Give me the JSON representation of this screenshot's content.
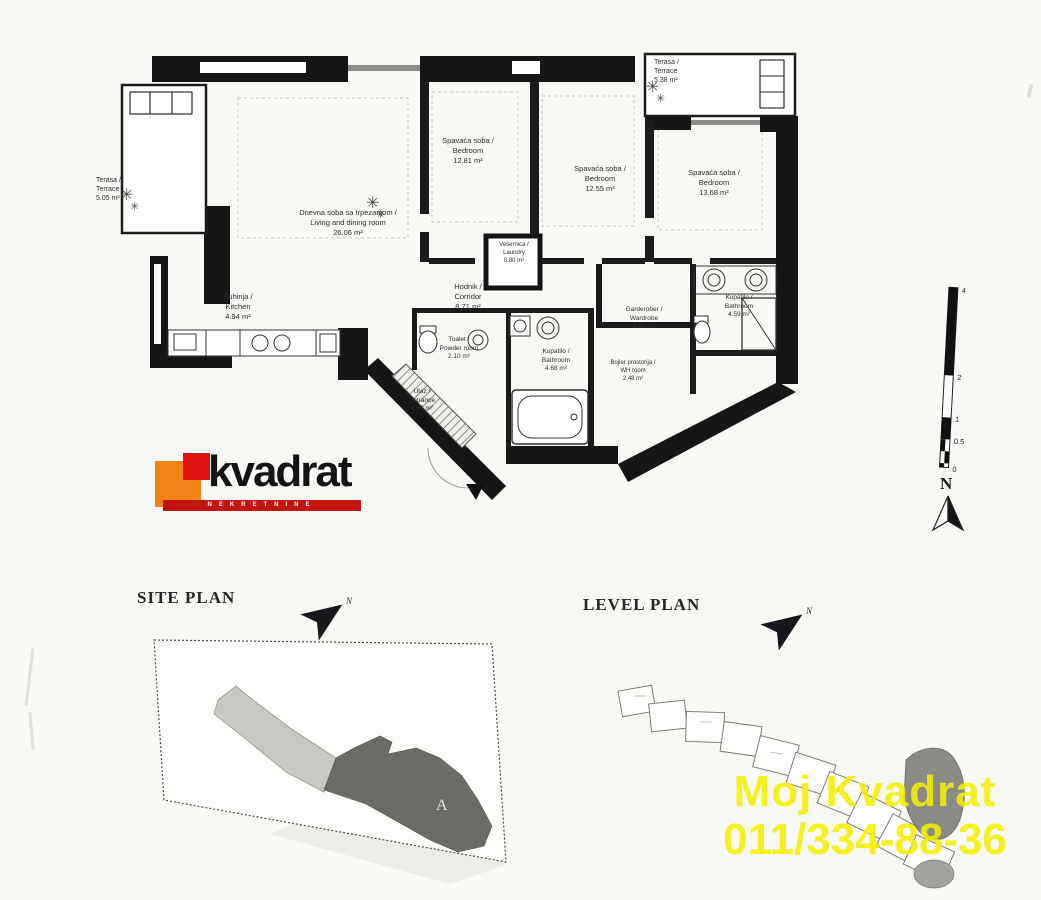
{
  "document": {
    "type_label": "apartment floor plan scan",
    "sections": {
      "site_plan_title": "SITE PLAN",
      "level_plan_title": "LEVEL PLAN"
    }
  },
  "logo": {
    "name": "kvadrat",
    "subtitle": "NEKRETNINE",
    "orange": "#ee8316",
    "red": "#e01410",
    "bar_red": "#c31510"
  },
  "rooms": {
    "terrace_left": {
      "sr": "Terasa /",
      "en": "Terrace",
      "area": "5.05 m²"
    },
    "living": {
      "sr": "Dnevna soba sa trpezarijom /",
      "en": "Living and dining room",
      "area": "26.06 m²"
    },
    "bedroom1": {
      "sr": "Spavaća soba /",
      "en": "Bedroom",
      "area": "12.81 m²"
    },
    "bedroom2": {
      "sr": "Spavaća soba /",
      "en": "Bedroom",
      "area": "12.55 m²"
    },
    "bedroom3": {
      "sr": "Spavaća soba /",
      "en": "Bedroom",
      "area": "13.68 m²"
    },
    "terrace_right": {
      "sr": "Terasa /",
      "en": "Terrace",
      "area": "5.38 m²"
    },
    "kitchen": {
      "sr": "Kuhinja /",
      "en": "Kitchen",
      "area": "4.94 m²"
    },
    "corridor": {
      "sr": "Hodnik /",
      "en": "Corridor",
      "area": "8.71 m²"
    },
    "laundry": {
      "sr": "Vešernica /",
      "en": "Laundry",
      "area": "0.80 m²"
    },
    "toilet": {
      "sr": "Toalet /",
      "en": "Powder room",
      "area": "2.10 m²"
    },
    "bathroom_main": {
      "sr": "Kupatilo /",
      "en": "Bathroom",
      "area": "4.68 m²"
    },
    "wardrobe": {
      "sr": "Garderober /",
      "en": "Wardrobe",
      "area": "3.93 m²"
    },
    "boiler": {
      "sr": "Bojler prostorija /",
      "en": "WH room",
      "area": "2.48 m²"
    },
    "bathroom_ensuite": {
      "sr": "Kupatilo /",
      "en": "Bathroom",
      "area": "4.59 m²"
    },
    "entrance": {
      "sr": "Ulaz /",
      "en": "Entrance",
      "area": "4.66 m²"
    }
  },
  "scale": {
    "labels": [
      "4",
      "2",
      "1",
      "0.5",
      "0"
    ]
  },
  "compass": {
    "n": "N"
  },
  "site_plan": {
    "building_label": "A"
  },
  "watermark": {
    "line1": "Moj Kvadrat",
    "line2": "011/334-88-36",
    "color": "#f4ee02"
  }
}
